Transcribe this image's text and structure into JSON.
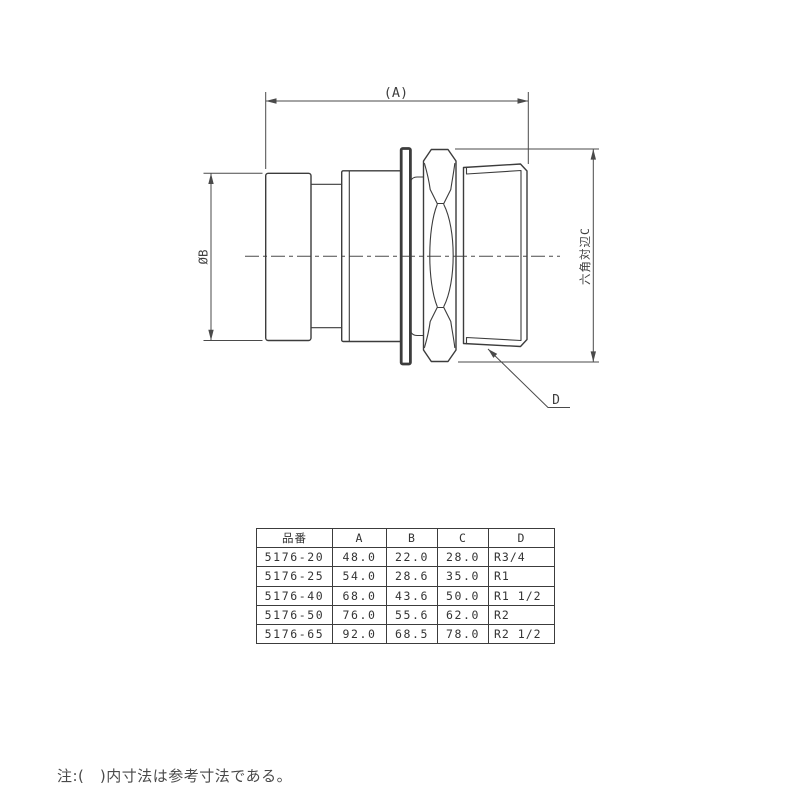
{
  "drawing": {
    "dim_a": "(A)",
    "dim_b": "ØB",
    "dim_c": "六角対辺C",
    "dim_d": "D"
  },
  "table": {
    "headers": [
      "品番",
      "A",
      "B",
      "C",
      "D"
    ],
    "rows": [
      [
        "5176-20",
        "48.0",
        "22.0",
        "28.0",
        "R3/4"
      ],
      [
        "5176-25",
        "54.0",
        "28.6",
        "35.0",
        "R1"
      ],
      [
        "5176-40",
        "68.0",
        "43.6",
        "50.0",
        "R1 1/2"
      ],
      [
        "5176-50",
        "76.0",
        "55.6",
        "62.0",
        "R2"
      ],
      [
        "5176-65",
        "92.0",
        "68.5",
        "78.0",
        "R2 1/2"
      ]
    ]
  },
  "note": "注:(　)内寸法は参考寸法である。",
  "colors": {
    "line": "#3c3c3c",
    "text": "#3f3f3f",
    "background": "#ffffff"
  }
}
